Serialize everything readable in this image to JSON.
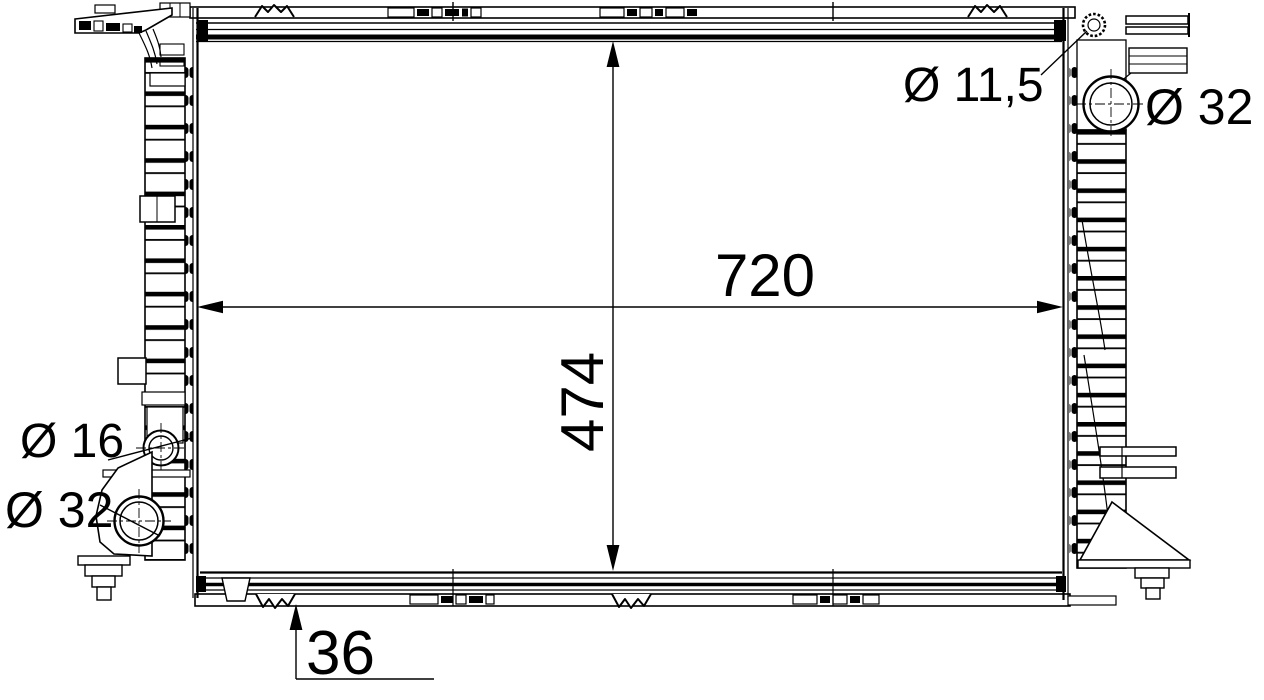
{
  "colors": {
    "background": "#ffffff",
    "line": "#000000"
  },
  "drawing": {
    "annotations": {
      "core_width": "720",
      "core_height": "474",
      "core_depth": "36",
      "mount_hole": "Ø 11,5",
      "port_top_right": "Ø 32",
      "port_left_small": "Ø 16",
      "port_bottom_left": "Ø 32"
    },
    "values": {
      "core_width_mm": 720,
      "core_height_mm": 474,
      "core_depth_mm": 36,
      "mount_hole_diameter_mm": 11.5,
      "port_top_right_diameter_mm": 32,
      "port_left_small_diameter_mm": 16,
      "port_bottom_left_diameter_mm": 32
    }
  }
}
